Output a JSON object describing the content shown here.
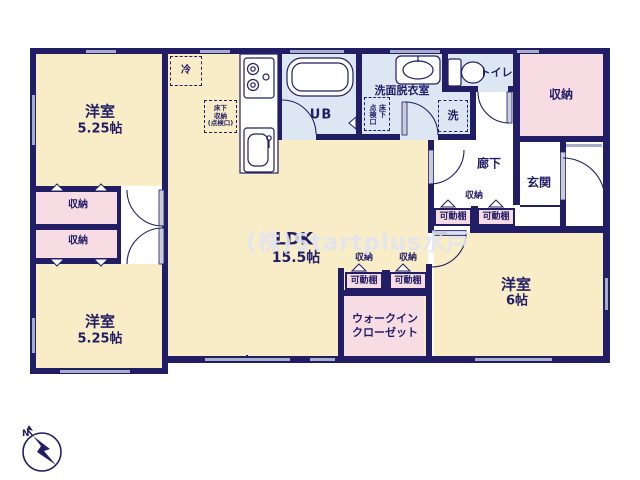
{
  "floor_plan": {
    "watermark": "(株)Startplus水戸",
    "compass": {
      "north_label": "N"
    },
    "rooms": {
      "bedroom_top_left": {
        "name": "洋室",
        "size": "5.25帖"
      },
      "bedroom_bottom_left": {
        "name": "洋室",
        "size": "5.25帖"
      },
      "ldk": {
        "name": "LDK",
        "size": "15.5帖"
      },
      "bedroom_right": {
        "name": "洋室",
        "size": "6帖"
      },
      "walk_in_closet": {
        "name_line1": "ウォークイン",
        "name_line2": "クローゼット"
      },
      "entrance": {
        "name": "玄関"
      },
      "hallway": {
        "name": "廊下"
      },
      "toilet": {
        "name": "トイレ"
      },
      "washroom": {
        "name": "洗面脱衣室"
      },
      "unit_bath": {
        "name": "UB"
      },
      "storage_top_right": {
        "name": "収納"
      },
      "storage_left_upper": {
        "name": "収納"
      },
      "storage_left_lower": {
        "name": "収納"
      },
      "hallway_closet": {
        "name": "収納"
      },
      "wic_closet_left": {
        "name": "収納"
      },
      "wic_closet_right": {
        "name": "収納"
      }
    },
    "labels": {
      "refrigerator": "冷",
      "washing_machine": "洗",
      "underfloor_storage_line1": "床下",
      "underfloor_storage_line2": "収納",
      "underfloor_storage_line3": "(点検口)",
      "underfloor_hatch_line1": "床下",
      "underfloor_hatch_line2": "点検口",
      "movable_shelves": [
        "可動棚",
        "可動棚",
        "可動棚",
        "可動棚"
      ]
    },
    "colors": {
      "wall": "#211e66",
      "room_fill": "#f9edc8",
      "closet_fill": "#f8dce3",
      "wet_area_fill": "#dde7f4",
      "window": "#a9aec8",
      "watermark": "#dfe4f2"
    }
  }
}
